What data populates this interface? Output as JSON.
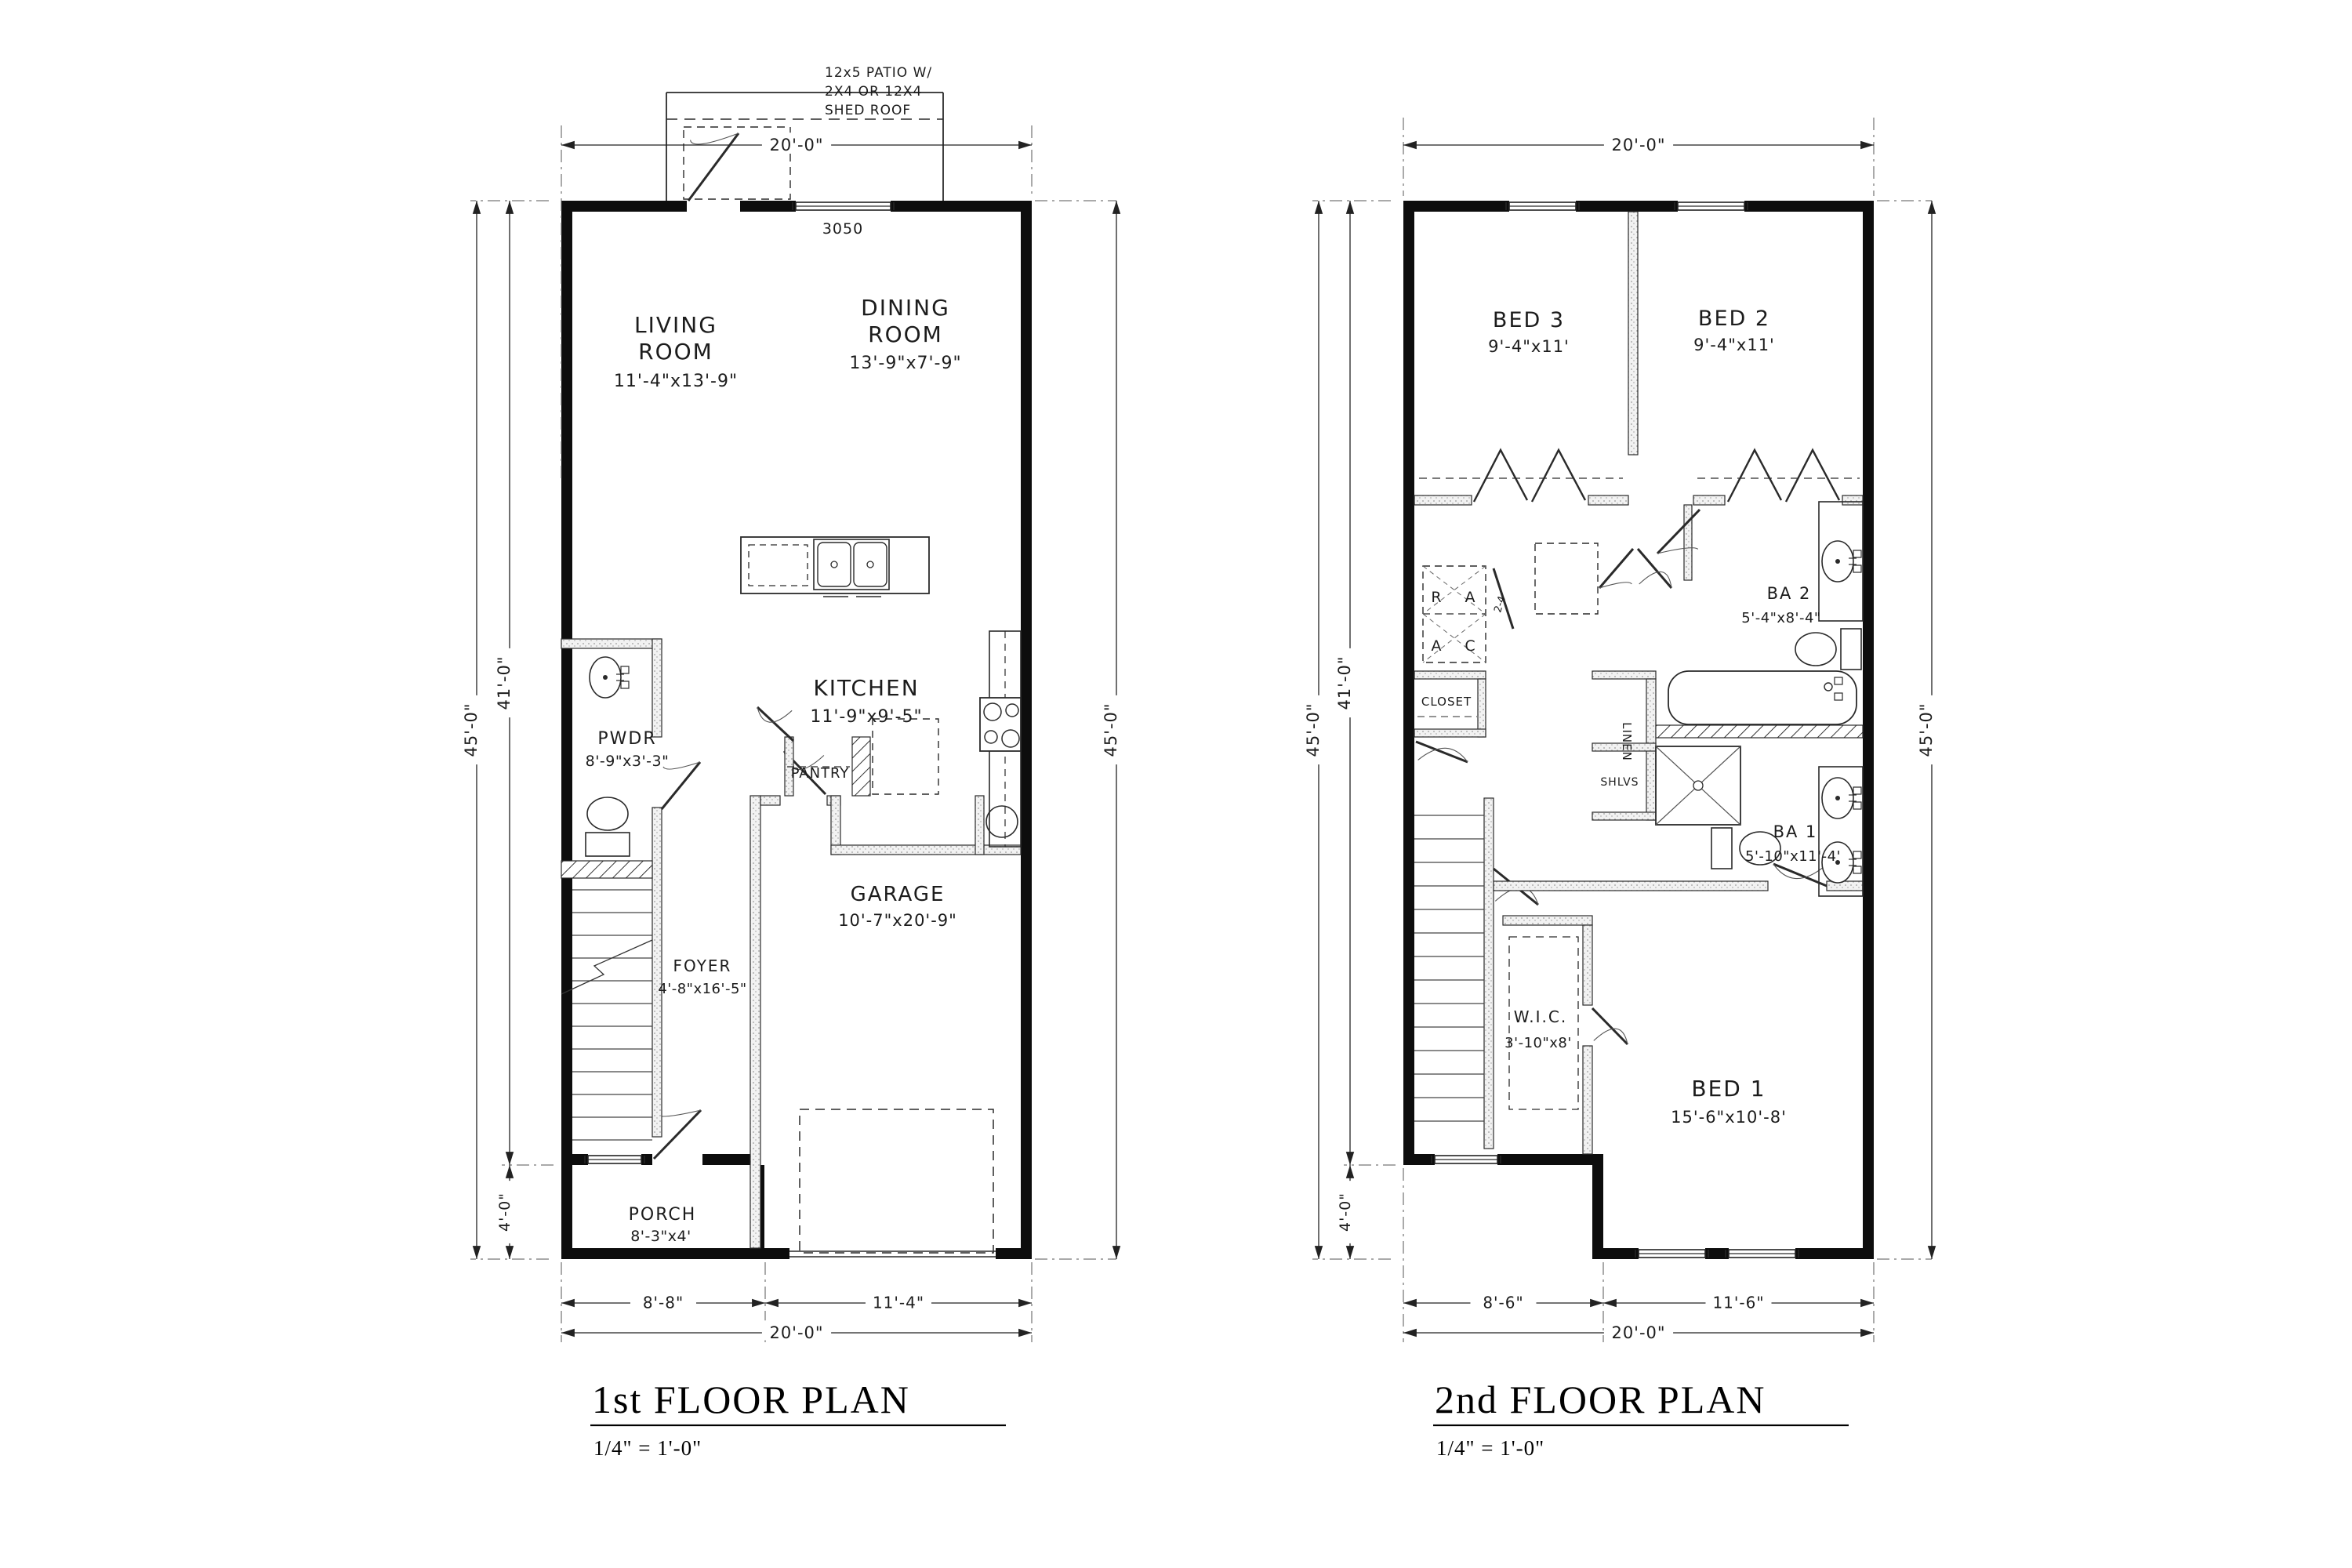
{
  "sheet": {
    "scale_note": "1/4\" = 1'-0\""
  },
  "floor_plans": [
    {
      "title": "1st FLOOR PLAN",
      "scale_note": "1/4\" = 1'-0\"",
      "rooms": {
        "living": {
          "line1": "LIVING",
          "line2": "ROOM",
          "size": "11'-4\"x13'-9\""
        },
        "dining": {
          "line1": "DINING",
          "line2": "ROOM",
          "size": "13'-9\"x7'-9\""
        },
        "kitchen": {
          "name": "KITCHEN",
          "size": "11'-9\"x9'-5\""
        },
        "pwdr": {
          "name": "PWDR",
          "size": "8'-9\"x3'-3\""
        },
        "pantry": {
          "name": "PANTRY"
        },
        "foyer": {
          "name": "FOYER",
          "size": "4'-8\"x16'-5\""
        },
        "garage": {
          "name": "GARAGE",
          "size": "10'-7\"x20'-9\""
        },
        "porch": {
          "name": "PORCH",
          "size": "8'-3\"x4'"
        }
      },
      "annotations": {
        "patio_line1": "12x5 PATIO W/",
        "patio_line2": "2X4 OR 12X4",
        "patio_line3": "SHED ROOF",
        "window_label": "3050"
      },
      "dims": {
        "top": "20'-0\"",
        "left_overall": "45'-0\"",
        "left_main": "41'-0\"",
        "left_lower": "4'-0\"",
        "right": "45'-0\"",
        "bottom_left": "8'-8\"",
        "bottom_right": "11'-4\"",
        "bottom_total": "20'-0\""
      }
    },
    {
      "title": "2nd FLOOR PLAN",
      "scale_note": "1/4\" = 1'-0\"",
      "rooms": {
        "bed3": {
          "name": "BED 3",
          "size": "9'-4\"x11'"
        },
        "bed2": {
          "name": "BED 2",
          "size": "9'-4\"x11'"
        },
        "bed1": {
          "name": "BED 1",
          "size": "15'-6\"x10'-8'"
        },
        "ba2": {
          "name": "BA 2",
          "size": "5'-4\"x8'-4\""
        },
        "ba1": {
          "name": "BA 1",
          "size": "5'-10\"x11'-4'"
        },
        "wic": {
          "name": "W.I.C.",
          "size": "3'-10\"x8'"
        },
        "closet": {
          "name": "CLOSET"
        },
        "linen": {
          "name": "LINEN"
        },
        "shlvs": {
          "name": "SHLVS"
        }
      },
      "annotations": {
        "hvac_r": "R",
        "hvac_a1": "A",
        "hvac_a2": "A",
        "hvac_c": "C",
        "door_label": "2-4"
      },
      "dims": {
        "top": "20'-0\"",
        "left_overall": "45'-0\"",
        "left_main": "41'-0\"",
        "left_lower": "4'-0\"",
        "right": "45'-0\"",
        "bottom_left": "8'-6\"",
        "bottom_right": "11'-6\"",
        "bottom_total": "20'-0\""
      }
    }
  ]
}
